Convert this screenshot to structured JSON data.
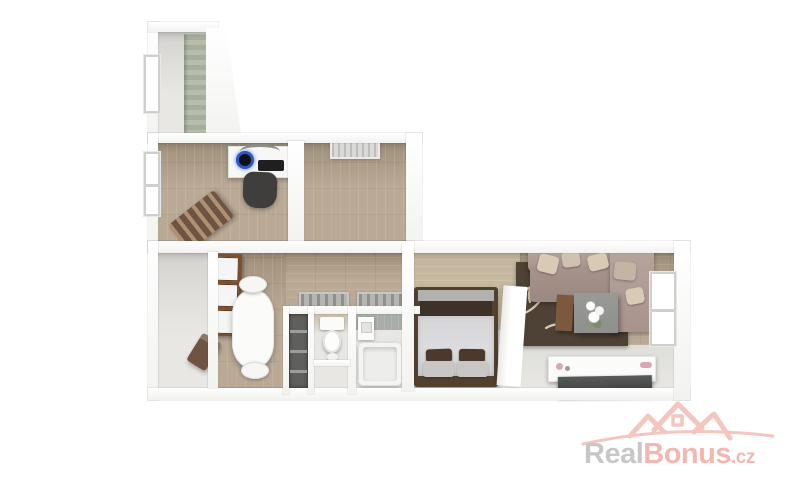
{
  "watermark": {
    "brand_part1": "Real",
    "brand_part2": "Bonus",
    "brand_suffix": ".cz",
    "icon": "three-rooftops-with-swoosh"
  },
  "colors": {
    "wood": "#b9a995",
    "wood_dark": "#a2927c",
    "wood_wall": "#c2b49c",
    "floor_light": "#e8e7e4",
    "floor_gray": "#d4d3ce",
    "rug": "#4e4136",
    "rug_pattern": "#d9c9b2",
    "sofa": "#a7938c",
    "sofa_light": "#b7a59e",
    "pillow": "#d9cab6",
    "bed_frame": "#53412f",
    "bed_panel": "#3e3228",
    "duvet": "#dcdcde",
    "pillow_dark": "#4c392b",
    "pillow_light": "#c9c7c5",
    "chair_dark": "#3f3e3d",
    "bench": "#6f5443",
    "monitor_ring": "#2b57c8",
    "keyboard": "#1f1f1f",
    "brown_frame": "#7c4f2e",
    "tile": "#a9ada9",
    "tub": "#f4f4f2",
    "coffee_table": "#8f8f8c",
    "side_table": "#7a5a3b",
    "tv": "#3a3a3a",
    "grate": "#b5b5b3",
    "closet": "#5f5f5d",
    "radiator": "#d9d9d7",
    "logo_gray": "#c7c7c7",
    "logo_pink": "#f2b7b1",
    "logo_roof": "#f5c5c0"
  },
  "scene": {
    "description": "3D rendered top-down floor plan of an apartment, white walls, wood floors",
    "rooms": [
      {
        "name": "balcony-closet",
        "features": [
          "window",
          "tiled-strip"
        ]
      },
      {
        "name": "office",
        "features": [
          "window",
          "desk",
          "computer",
          "keyboard",
          "office-chair",
          "storage-bench"
        ]
      },
      {
        "name": "empty-room",
        "features": [
          "radiator"
        ]
      },
      {
        "name": "utility-room",
        "features": [
          "dark-chair"
        ]
      },
      {
        "name": "dining-area",
        "features": [
          "open-casement-window",
          "oval-dining-table",
          "two-chairs"
        ]
      },
      {
        "name": "hallway",
        "features": [
          "doormat",
          "doormat"
        ]
      },
      {
        "name": "closet-niche",
        "features": [
          "shelves"
        ]
      },
      {
        "name": "wc",
        "features": [
          "toilet"
        ]
      },
      {
        "name": "bathroom",
        "features": [
          "sink",
          "bathtub",
          "tiled-wall"
        ]
      },
      {
        "name": "bedroom",
        "features": [
          "double-bed",
          "dark-pillows",
          "wood-panel-wall",
          "partition-wall"
        ]
      },
      {
        "name": "living-room",
        "features": [
          "corner-sofa",
          "throw-pillows",
          "antler-pattern-rug",
          "coffee-table",
          "side-table",
          "flowers",
          "tv-sideboard",
          "tv-panel",
          "window"
        ]
      }
    ]
  }
}
